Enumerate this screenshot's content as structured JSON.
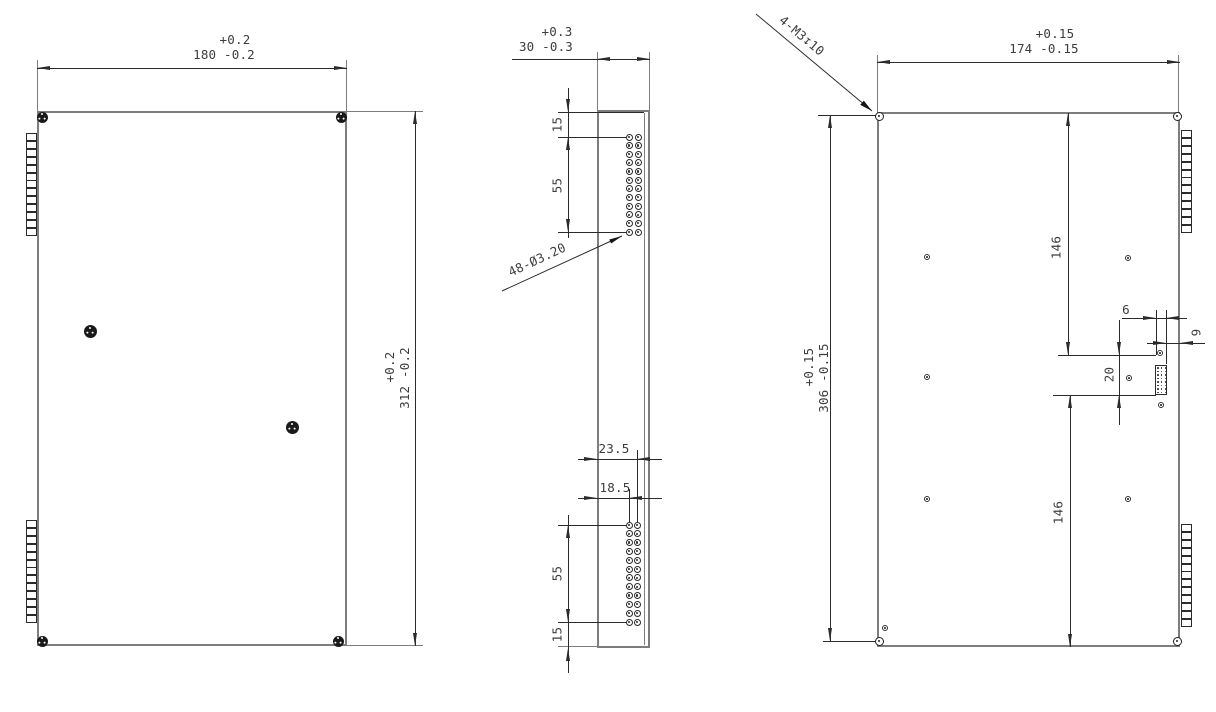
{
  "views": {
    "front": {
      "width": {
        "tol": "+0.2",
        "val": "180 -0.2"
      },
      "height": {
        "tol": "+0.2",
        "val": "312 -0.2"
      }
    },
    "side": {
      "width": {
        "tol": "+0.3",
        "val": "30 -0.3"
      },
      "offset_top": "15",
      "span_top": "55",
      "hole_callout": "48-Ø3.20",
      "edge_dist_a": "23.5",
      "edge_dist_b": "18.5",
      "span_bottom": "55",
      "offset_bottom": "15"
    },
    "back": {
      "width": {
        "tol": "+0.15",
        "val": "174 -0.15"
      },
      "height": {
        "tol": "+0.15",
        "val": "306 -0.15"
      },
      "span_upper": "146",
      "span_lower": "146",
      "cutout_width": "6",
      "cutout_edge": "9",
      "cutout_height": "20",
      "thread_callout": "4-M3↧10"
    }
  },
  "geometry": {
    "side_hole_rows": 12,
    "side_hole_cols": 2,
    "total_holes": 48,
    "connector_pins_per_block": 13,
    "connector_blocks": 4,
    "footprint_dot_rows": 8,
    "footprint_dot_cols": 3
  },
  "colors": {
    "background": "#ffffff",
    "part_outline": "#7d7d7d",
    "dimension_line": "#2b2b2b",
    "text": "#3d3d3d",
    "screw_fill": "#191919"
  }
}
